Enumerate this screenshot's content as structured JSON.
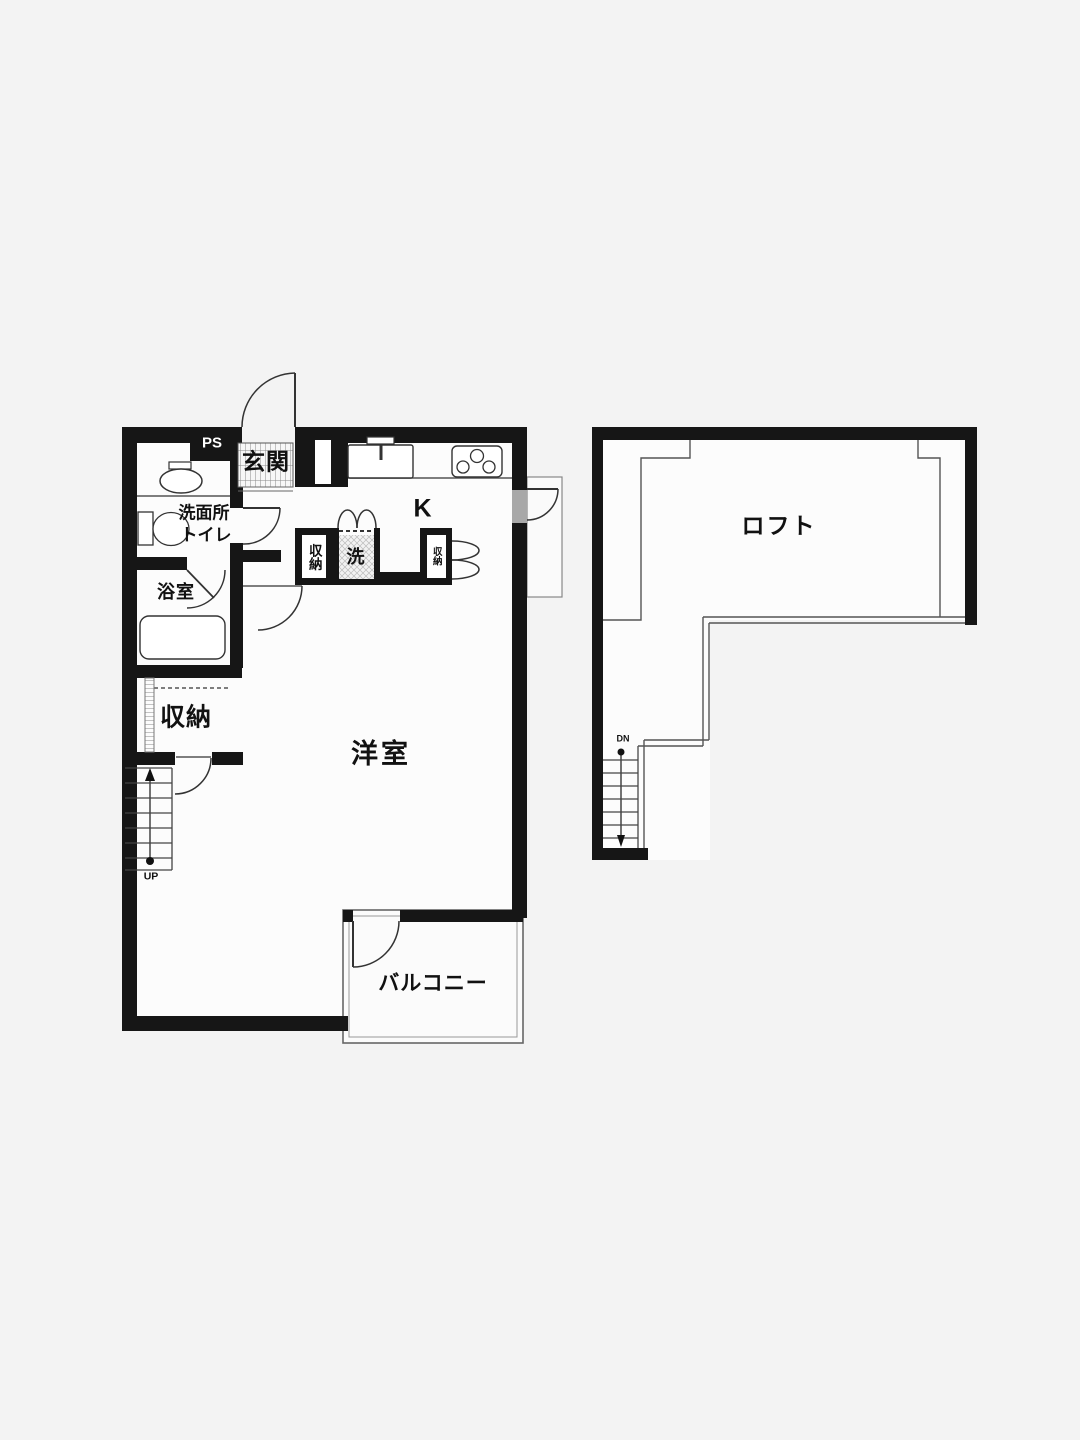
{
  "document_type": "floor-plan",
  "colors": {
    "background": "#f3f3f3",
    "room_fill": "#fcfcfc",
    "wall": "#161616",
    "thin_line": "#555555",
    "text": "#111111",
    "door_opening_fill": "#a8a8a8"
  },
  "main_floor": {
    "labels": {
      "pipe_space": "PS",
      "entrance": "玄関",
      "washroom_line1": "洗面所",
      "washroom_line2": "トイレ",
      "bathroom": "浴室",
      "closet": "収納",
      "hall_closet": "収納",
      "washer": "洗",
      "kitchen_closet": "収納",
      "kitchen": "K",
      "western_room": "洋室",
      "balcony": "バルコニー",
      "stairs_up": "UP"
    },
    "fixtures": [
      "washbasin",
      "toilet",
      "bathtub",
      "kitchen-sink",
      "gas-stove-3-burner",
      "washing-machine-space",
      "staircase-up-7-steps",
      "entrance-swing-door",
      "washroom-swing-door",
      "bathroom-swing-door",
      "hall-swing-door",
      "closet-swing-door",
      "side-swing-door",
      "balcony-swing-door",
      "bifold-door-washer",
      "bifold-door-kitchen-closet"
    ]
  },
  "loft_floor": {
    "labels": {
      "loft": "ロフト",
      "stairs_down": "DN"
    },
    "fixtures": [
      "staircase-down-7-steps",
      "void-railing-lines"
    ]
  }
}
